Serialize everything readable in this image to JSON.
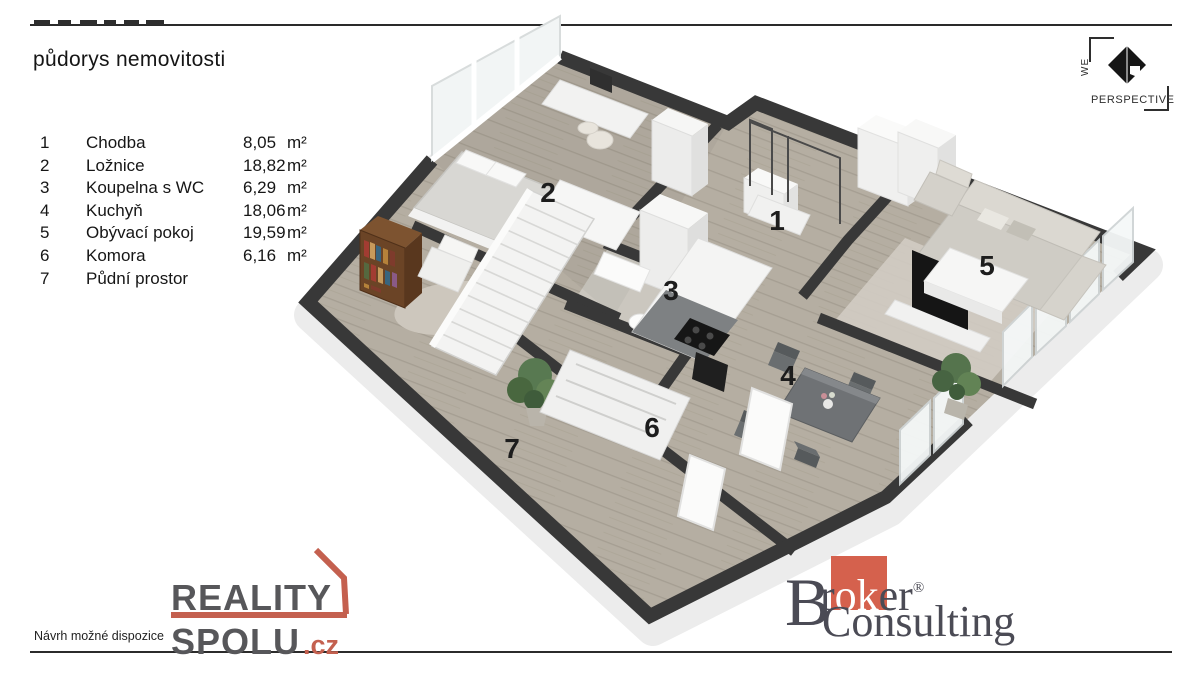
{
  "header": {
    "title": "půdorys nemovitosti"
  },
  "legend": {
    "rows": [
      {
        "num": "1",
        "name": "Chodba",
        "area": "8,05",
        "unit": "m²"
      },
      {
        "num": "2",
        "name": "Ložnice",
        "area": "18,82",
        "unit": "m²"
      },
      {
        "num": "3",
        "name": "Koupelna s WC",
        "area": "6,29",
        "unit": "m²"
      },
      {
        "num": "4",
        "name": "Kuchyň",
        "area": "18,06",
        "unit": "m²"
      },
      {
        "num": "5",
        "name": "Obývací pokoj",
        "area": "19,59",
        "unit": "m²"
      },
      {
        "num": "6",
        "name": "Komora",
        "area": "6,16",
        "unit": "m²"
      },
      {
        "num": "7",
        "name": "Půdní prostor",
        "area": "",
        "unit": ""
      }
    ]
  },
  "plan": {
    "labels": [
      "1",
      "2",
      "3",
      "4",
      "5",
      "6",
      "7"
    ]
  },
  "footer": {
    "note": "Návrh možné dispozice"
  },
  "logos": {
    "reality": {
      "line1": "REALITY",
      "line2": "SPOLU",
      "tld": ".cz",
      "text_color": "#57575a",
      "accent": "#c4604f"
    },
    "broker": {
      "b": "B",
      "r": "r",
      "ok": "ok",
      "er": "er",
      "reg": "®",
      "word2": "Consulting",
      "text_color": "#4b4b55",
      "accent": "#d5614d"
    },
    "perspective": {
      "we": "WE",
      "word": "PERSPECTIVE"
    }
  },
  "colors": {
    "wall": "#383838",
    "floor": "#b5aea2",
    "slab": "#ededed",
    "label": "#1d1d1d"
  }
}
